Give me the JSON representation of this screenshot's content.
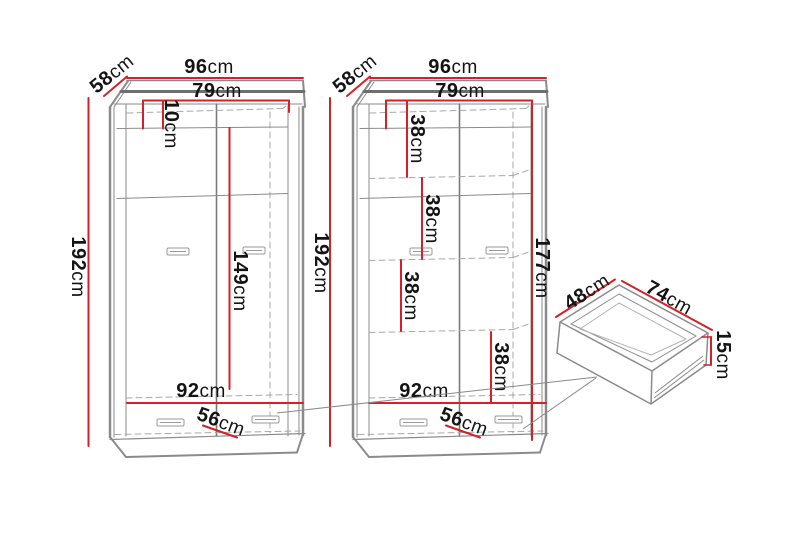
{
  "page": {
    "background": "#ffffff",
    "description": "Furniture dimension diagram of two wardrobes and a drawer"
  },
  "colors": {
    "dimension_red": "#d42026",
    "structure_gray": "#8b8b8b",
    "structure_dark_gray": "#6e6e6e",
    "dashed_gray": "#a8a8a8",
    "text_black": "#141414"
  },
  "diagram": {
    "wardrobe_left": {
      "width": {
        "value": "96",
        "unit": "cm"
      },
      "depth": {
        "value": "58",
        "unit": "cm"
      },
      "interior_width": {
        "value": "79",
        "unit": "cm"
      },
      "top_gap": {
        "value": "10",
        "unit": "cm"
      },
      "height": {
        "value": "192",
        "unit": "cm"
      },
      "interior_height": {
        "value": "149",
        "unit": "cm"
      },
      "bottom_interior_width": {
        "value": "92",
        "unit": "cm"
      },
      "drawer_front_width": {
        "value": "56",
        "unit": "cm"
      }
    },
    "wardrobe_right": {
      "width": {
        "value": "96",
        "unit": "cm"
      },
      "depth": {
        "value": "58",
        "unit": "cm"
      },
      "interior_width": {
        "value": "79",
        "unit": "cm"
      },
      "shelf_gap_1": {
        "value": "38",
        "unit": "cm"
      },
      "shelf_gap_2": {
        "value": "38",
        "unit": "cm"
      },
      "shelf_gap_3": {
        "value": "38",
        "unit": "cm"
      },
      "shelf_gap_4": {
        "value": "38",
        "unit": "cm"
      },
      "height": {
        "value": "192",
        "unit": "cm"
      },
      "interior_height": {
        "value": "177",
        "unit": "cm"
      },
      "bottom_interior_width": {
        "value": "92",
        "unit": "cm"
      },
      "drawer_front_width": {
        "value": "56",
        "unit": "cm"
      }
    },
    "drawer": {
      "depth": {
        "value": "48",
        "unit": "cm"
      },
      "width": {
        "value": "74",
        "unit": "cm"
      },
      "height": {
        "value": "15",
        "unit": "cm"
      }
    }
  }
}
